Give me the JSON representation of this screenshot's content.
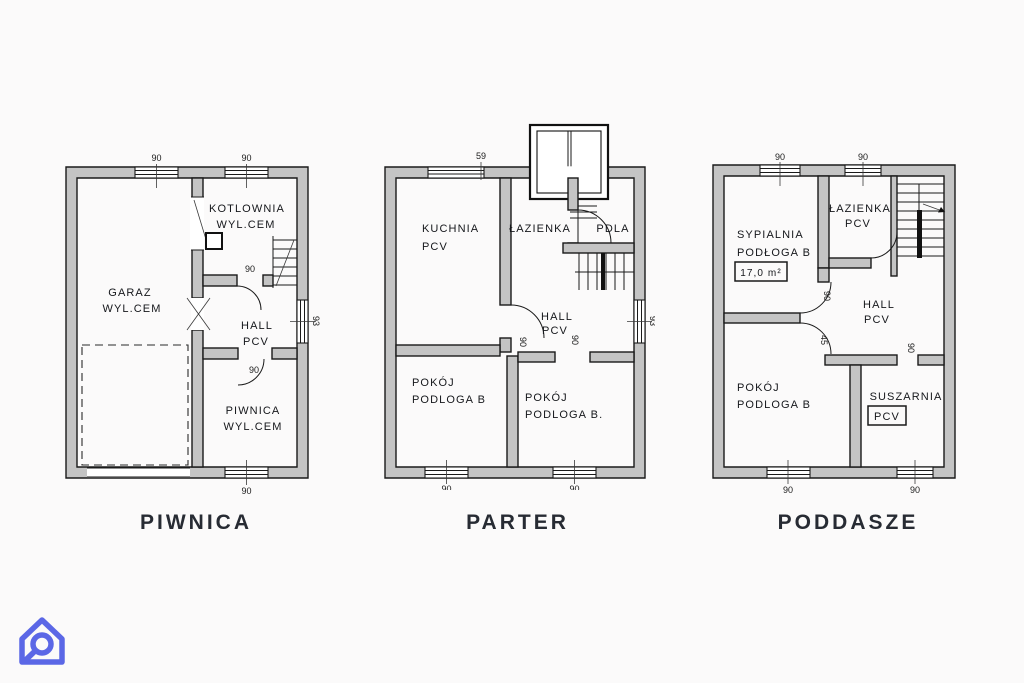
{
  "page": {
    "background": "#fbfafa"
  },
  "logo": {
    "icon": "house-loop-logo",
    "color": "#5b67e6"
  },
  "floors": [
    {
      "title": "PIWNICA",
      "rooms": {
        "garaz": [
          "GARAZ",
          "WYL.CEM"
        ],
        "kotlownia": [
          "KOTLOWNIA",
          "WYL.CEM"
        ],
        "hall": [
          "HALL",
          "PCV"
        ],
        "piwnica": [
          "PIWNICA",
          "WYL.CEM"
        ]
      },
      "dims": {
        "win_top_left": "90",
        "win_top_right": "90",
        "win_right": "93",
        "win_bottom": "90",
        "door_kotlownia": "90",
        "door_piwnica": "90"
      }
    },
    {
      "title": "PARTER",
      "rooms": {
        "kuchnia": [
          "KUCHNIA",
          "PCV"
        ],
        "lazienka": [
          "ŁAZIENKA",
          "PDLA"
        ],
        "hall": [
          "HALL",
          "PCV"
        ],
        "pokoj_left": [
          "POKÓJ",
          "PODLOGA B"
        ],
        "pokoj_right": [
          "POKÓJ",
          "PODLOGA B."
        ]
      },
      "dims": {
        "top": "59",
        "win_right": "93",
        "win_bottom_left": "90",
        "win_bottom_right": "90",
        "door_hall": "90",
        "door_pokoj": "90"
      }
    },
    {
      "title": "PODDASZE",
      "rooms": {
        "sypialnia": [
          "SYPIALNIA",
          "PODŁOGA B"
        ],
        "sypialnia_area": "17,0 m²",
        "lazienka": [
          "ŁAZIENKA",
          "PCV"
        ],
        "hall": [
          "HALL",
          "PCV"
        ],
        "pokoj": [
          "POKÓJ",
          "PODLOGA B"
        ],
        "suszarnia": [
          "SUSZARNIA",
          "PCV"
        ]
      },
      "dims": {
        "win_top_left": "90",
        "win_top_right": "90",
        "door_sypialnia": "90",
        "door_pokoj": "45",
        "door_suszarnia": "90",
        "win_bottom_left": "90",
        "win_bottom_right": "90"
      }
    }
  ]
}
